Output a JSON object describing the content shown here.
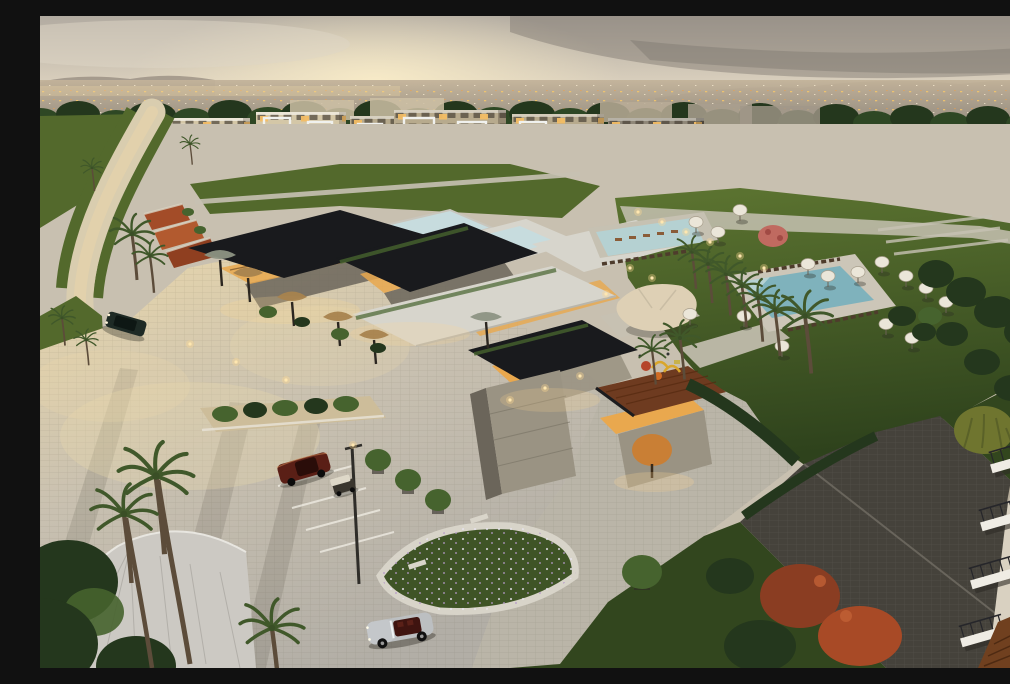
{
  "scene": {
    "type": "architectural-aerial-render",
    "time_of_day": "dusk",
    "description": "Aerial dusk rendering of a residential compound: curved rows of 3-4 storey apartment blocks against a glowing city horizon, a modern clubhouse with flat black roofs, warm-lit glass walls and rooftop reflecting pools, lawns with swimming pools, white umbrellas and loungers, palm-lined cobblestone roads and plazas, parked cars and a golf cart, a close apartment facade with balconies at the lower right edge.",
    "objects": {
      "apartment_rows": "cream blocks on the left fading to gray-brown blocks on the right, white balcony frames, scattered amber-lit windows",
      "clubhouse": "stacked flat-roof pavilions, sculptural gold shade canopies, cream tensile tent, stone walls, wooden roof deck, uplit tree",
      "pools": [
        "rooftop reflecting pools",
        "lap pool with in-water loungers",
        "leisure pool with sun deck"
      ],
      "vehicles": [
        "dark sedan driving on the left road",
        "maroon coupe parked",
        "golf cart",
        "silver convertible with red interior"
      ],
      "landscape": [
        "tall palms",
        "hedges",
        "flowering trees",
        "white umbrellas on lawns",
        "playground",
        "cobblestone plaza with parking bays",
        "path lights"
      ]
    }
  },
  "palette": {
    "sky_top": "#b2aba1",
    "sky_mid": "#d8cebc",
    "sky_horizon": "#efd6a6",
    "sun_glow": "#f9ecc8",
    "cloud_dark": "#77716a",
    "mountain": "#8a7f74",
    "city_light": "#c3b39a",
    "city_dark": "#938b7f",
    "window_amber": "#f3bc64",
    "treeline": "#2e4724",
    "tree_green": "#46632e",
    "tree_dark": "#24371d",
    "bldg_cream": "#d4c7a7",
    "bldg_tan": "#b7aa8d",
    "bldg_gray": "#8f8778",
    "bldg_gray_dark": "#746d60",
    "frame_white": "#f0f1ee",
    "window_dark": "#4a4337",
    "roof_black": "#191a1d",
    "roof_pale": "#d7d5cc",
    "pool_roof": "#c7dcde",
    "stone": "#9a9383",
    "stone_dark": "#6b655a",
    "glass_warm": "#e9a84e",
    "wood_deck": "#6e3b20",
    "plaza_light": "#c8c0b0",
    "plaza_warm": "#ecd9ab",
    "cobble_dark": "#45423b",
    "road_light": "#d9cdaf",
    "lawn": "#53692c",
    "lawn_dark": "#32461e",
    "path_pale": "#c6c1b2",
    "water": "#7fb2bc",
    "water_light": "#b5d1d2",
    "umbrella": "#ebe6d9",
    "canopy_cream": "#ded0b5",
    "canopy_gold": "#a8834e",
    "flower_red": "#a84a26",
    "flower_pink": "#c06a60",
    "palm_trunk": "#5c4c3a",
    "palm_frond": "#40582a",
    "car_maroon": "#5a1f16",
    "car_dark": "#1e2a25",
    "car_silver": "#bcbfc1",
    "lamp_glow": "#ffd993",
    "wall_cream": "#d9d1c1",
    "willow": "#6f752f"
  }
}
